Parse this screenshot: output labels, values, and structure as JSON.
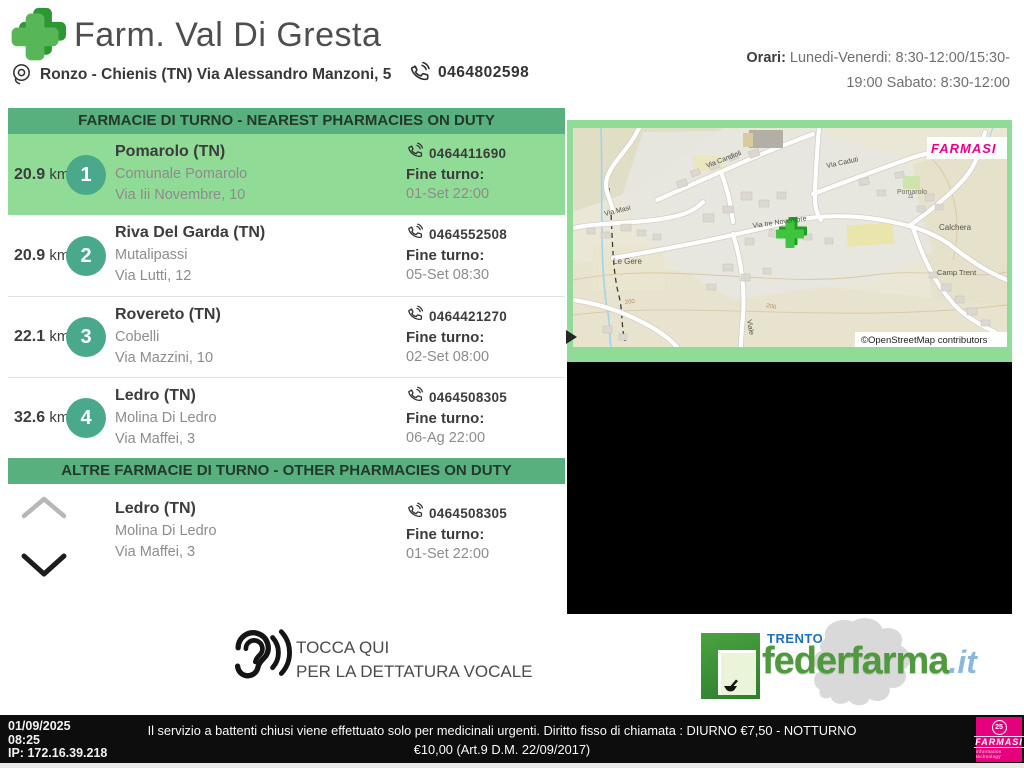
{
  "colors": {
    "section_bar_green": "#57b07e",
    "row_highlight_green": "#90db96",
    "badge_green": "#4aa98a",
    "cross_green_front": "#57b757",
    "cross_green_back": "#2c9733",
    "farmasi_magenta": "#e6007e",
    "footer_black": "#0d0d0d"
  },
  "header": {
    "title": "Farm. Val Di Gresta",
    "address": "Ronzo - Chienis (TN) Via Alessandro Manzoni, 5",
    "phone": "0464802598",
    "hours_label": "Orari:",
    "hours_line1": "Lunedi-Venerdi: 8:30-12:00/15:30-",
    "hours_line2": "19:00 Sabato: 8:30-12:00"
  },
  "duty": {
    "title": "FARMACIE DI TURNO - NEAREST PHARMACIES ON DUTY",
    "fine_turno_label": "Fine turno:",
    "rows": [
      {
        "distance": "20.9",
        "unit": "km",
        "rank": "1",
        "city": "Pomarolo (TN)",
        "name": "Comunale Pomarolo",
        "street": "Via Iii Novembre, 10",
        "phone": "0464411690",
        "fine_turno": "01-Set 22:00"
      },
      {
        "distance": "20.9",
        "unit": "km",
        "rank": "2",
        "city": "Riva Del Garda (TN)",
        "name": "Mutalipassi",
        "street": "Via Lutti, 12",
        "phone": "0464552508",
        "fine_turno": "05-Set 08:30"
      },
      {
        "distance": "22.1",
        "unit": "km",
        "rank": "3",
        "city": "Rovereto (TN)",
        "name": "Cobelli",
        "street": "Via Mazzini, 10",
        "phone": "0464421270",
        "fine_turno": "02-Set 08:00"
      },
      {
        "distance": "32.6",
        "unit": "km",
        "rank": "4",
        "city": "Ledro (TN)",
        "name": "Molina Di Ledro",
        "street": "Via Maffei, 3",
        "phone": "0464508305",
        "fine_turno": "06-Ag 22:00"
      }
    ]
  },
  "other": {
    "title": "ALTRE FARMACIE DI TURNO - OTHER PHARMACIES ON DUTY",
    "fine_turno_label": "Fine turno:",
    "row": {
      "city": "Ledro (TN)",
      "name": "Molina Di Ledro",
      "street": "Via Maffei, 3",
      "phone": "0464508305",
      "fine_turno": "01-Set 22:00"
    }
  },
  "map": {
    "watermark": "FARMASI",
    "attribution": "©OpenStreetMap contributors",
    "labels": {
      "via_masi": "Via Masi",
      "via_candioli": "Via Candioli",
      "via_caduti": "Via Caduti",
      "via_tre_novembre": "Via tre Novembre",
      "le_gere": "Le Gere",
      "pomarolo": "Pomarolo",
      "calchera": "Calchera",
      "camp_trent": "Camp Trent",
      "viale": "Viale",
      "contour": "200"
    }
  },
  "voice": {
    "line1": "TOCCA QUI",
    "line2": "PER LA DETTATURA VOCALE"
  },
  "federfarma": {
    "region": "TRENTO",
    "brand": "federfarma",
    "tld": ".it"
  },
  "footer": {
    "date": "01/09/2025",
    "time": "08:25",
    "ip": "IP: 172.16.39.218",
    "notice_line1": "Il servizio a battenti chiusi viene effettuato solo per medicinali urgenti. Diritto fisso di chiamata : DIURNO €7,50 - NOTTURNO",
    "notice_line2": "€10,00 (Art.9 D.M. 22/09/2017)",
    "farmasi": {
      "badge": "25",
      "name": "FARMASI",
      "tagline": "information technology"
    }
  }
}
